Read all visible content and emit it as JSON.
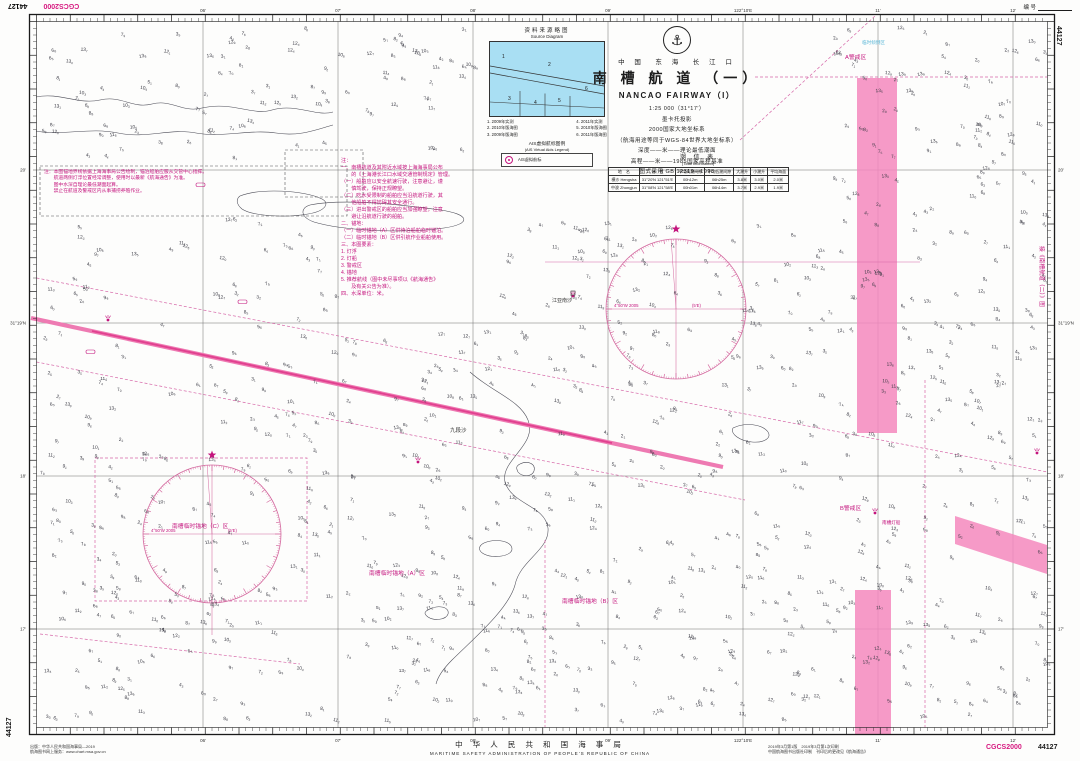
{
  "corner": {
    "datum": "CGCS2000",
    "number": "44127",
    "serial_label": "编 号"
  },
  "title_block": {
    "emblem_icon": "anchor-emblem",
    "region": "中 国　东 海　长 江 口",
    "title_cn": "南 槽 航 道 （一）",
    "title_en": "NANCAO FAIRWAY（I）",
    "scale": "1:25 000（31°17′）",
    "projection": "墨卡托投影",
    "datum_line": "2000国家大地坐标系",
    "datum_note": "（航海用途等同于WGS-84世界大地坐标系）",
    "depth_line": "深度——米——理论最低潮面",
    "height_line": "高程——米——1985国家高程基准",
    "style_line": "图式采用 GB 12319—1998"
  },
  "tide_table": {
    "title": "潮 信 表",
    "subtitle": "(Tidal Information)",
    "headers": [
      "地　名",
      "位　置",
      "平均高潮间隙",
      "平均低潮间隙",
      "大潮升",
      "小潮升",
      "平均海面"
    ],
    "rows": [
      [
        "横沙 Hengsha",
        "31°20′N 121°51′E",
        "00h12m",
        "06h25m",
        "3.8米",
        "3.0米",
        "2.0米"
      ],
      [
        "中浚 Zhongjun",
        "31°08′N 121°58′E",
        "00h01m",
        "06h14m",
        "3.7米",
        "2.9米",
        "1.9米"
      ]
    ]
  },
  "source_diagram": {
    "title": "资料来源略图",
    "subtitle": "Source Diagram",
    "region_numbers": [
      "1",
      "2",
      "3",
      "4",
      "5",
      "6"
    ],
    "legend_left": [
      "1. 2009年实测",
      "2. 2010年版海图",
      "3. 2009年版海图"
    ],
    "legend_right": [
      "4. 2011年实测",
      "5. 2010年版海图",
      "6. 2011年版海图"
    ],
    "ais_title": "AIS虚拟航标图例",
    "ais_subtitle": "(AIS Virtual Aids Legend)",
    "ais_symbol": "ais-virtual-aid-icon",
    "ais_label": "AIS虚拟航标"
  },
  "notes_right": {
    "lines": [
      "注：",
      "一、南槽航道及其附近水域按上海海事局公布",
      "　　的《上海港长江口水域交通管制规定》管理。",
      "（一）船舶应以安全航速行驶，注意避让，谨",
      "　　慎驾驶，保持正规瞭望。",
      "（二）吃水受限制的船舶应当沿航道行驶，其",
      "　　他船舶不得妨碍其安全通行。",
      "（三）进出警戒区的船舶应当加强瞭望，注意",
      "　　避让沿航道行驶的船舶。",
      "二、锚地：",
      "（一）临时锚地（A）区供待泊船舶临时锚泊。",
      "（二）临时锚地（B）区供引航作业船舶使用。",
      "三、本图要素：",
      "1. 灯浮",
      "2. 灯船",
      "3. 警戒区",
      "4. 锚地",
      "5. 推荐航线（图中未尽事项以《航海通告》",
      "　　及有关公告为准）。",
      "四、水深单位：米。"
    ]
  },
  "notes_left": {
    "lines": [
      "注：本图锚地界线依据上海海事局公告绘制，锚泊船舶应服从交管中心指挥。",
      "　　航道两侧灯浮位置经常调整，使用时以最新《航海通告》为准。",
      "　　图中水深自理论最低潮面起算。",
      "　　禁止在航道及警戒区内从事捕捞养殖作业。"
    ]
  },
  "compass": {
    "variation_left": "4°50′W 2005",
    "variation_right": "(5′E)"
  },
  "labels": [
    {
      "text": "A警戒区",
      "x": 845,
      "y": 59,
      "color": "mag",
      "size": 5.8
    },
    {
      "text": "B警戒区",
      "x": 840,
      "y": 510,
      "color": "mag",
      "size": 5.8
    },
    {
      "text": "南槽临时锚地（A）区",
      "x": 369,
      "y": 575,
      "color": "mag",
      "size": 5.8
    },
    {
      "text": "南槽临时锚地（B）区",
      "x": 562,
      "y": 603,
      "color": "mag",
      "size": 5.8
    },
    {
      "text": "南槽临时锚地（C）区",
      "x": 172,
      "y": 528,
      "color": "mag",
      "size": 5.8
    },
    {
      "text": "临时倾倒区",
      "x": 862,
      "y": 44,
      "color": "cyan",
      "size": 4.6
    },
    {
      "text": "江亚南沙",
      "x": 552,
      "y": 302,
      "color": "dark",
      "size": 5
    },
    {
      "text": "九段沙",
      "x": 450,
      "y": 432,
      "color": "dark",
      "size": 5.5
    },
    {
      "text": "南槽灯船",
      "x": 882,
      "y": 524,
      "color": "mag",
      "size": 4.6
    },
    {
      "text": "接《南槽航道（二）》图",
      "x": 1040,
      "y": 246,
      "color": "mag",
      "size": 5.8,
      "rotate": 90
    }
  ],
  "border": {
    "top_labels": [
      {
        "x": 203,
        "t": "06′"
      },
      {
        "x": 338,
        "t": "07′"
      },
      {
        "x": 473,
        "t": "08′"
      },
      {
        "x": 608,
        "t": "09′"
      },
      {
        "x": 743,
        "t": "122°10′E"
      },
      {
        "x": 878,
        "t": "11′"
      },
      {
        "x": 1013,
        "t": "12′"
      }
    ],
    "bottom_labels": [
      {
        "x": 203,
        "t": "06′"
      },
      {
        "x": 338,
        "t": "07′"
      },
      {
        "x": 473,
        "t": "08′"
      },
      {
        "x": 608,
        "t": "09′"
      },
      {
        "x": 743,
        "t": "122°10′E"
      },
      {
        "x": 878,
        "t": "11′"
      },
      {
        "x": 1013,
        "t": "12′"
      }
    ],
    "side_labels": [
      {
        "y": 170,
        "t": "20′"
      },
      {
        "y": 323,
        "t": "31°19′N"
      },
      {
        "y": 476,
        "t": "18′"
      },
      {
        "y": 629,
        "t": "17′"
      }
    ]
  },
  "soundings": {
    "seed": 20190314,
    "count": 1150,
    "min_val": 2,
    "max_val": 13
  },
  "footer": {
    "left_line1": "出版：中华人民共和国海事局—2019",
    "left_line2": "航海图书网上服务：www.chart.msa.gov.cn",
    "center_cn": "中 华 人 民 共 和 国 海 事 局",
    "center_en": "MARITIME SAFETY ADMINISTRATION OF PEOPLE'S REPUBLIC OF CHINA",
    "right_line1": "2019年3月第1版　2019年3月第1次印刷",
    "right_line2": "中国航海图书出版社印制　刊印后的更改见《航海通告》",
    "datum": "CGCS2000",
    "number": "44127"
  },
  "colors": {
    "magenta": "#c4147d",
    "magenta_dash": "#d667a8",
    "band_fill": "#f488bd",
    "fairway": "#ee7ab2",
    "fairway_core": "#e1408f",
    "compass": "#d4699f",
    "cyan": "#5db8d8",
    "contour": "#4a4a55",
    "graticule": "#6f6f6f",
    "border_ink": "#1a1a1a",
    "sounding_ink": "#3a3a44"
  }
}
